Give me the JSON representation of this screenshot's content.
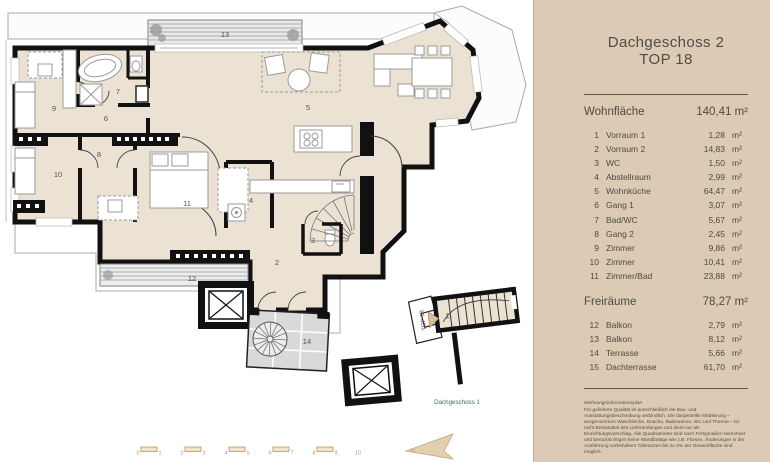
{
  "panel": {
    "title_line1": "Dachgeschoss 2",
    "title_line2": "TOP 18",
    "unit": "m²",
    "wohnflaeche": {
      "label": "Wohnfläche",
      "total": "140,41 m²",
      "items": [
        {
          "nr": "1",
          "name": "Vorraum 1",
          "area": "1,28"
        },
        {
          "nr": "2",
          "name": "Vorraum 2",
          "area": "14,83"
        },
        {
          "nr": "3",
          "name": "WC",
          "area": "1,50"
        },
        {
          "nr": "4",
          "name": "Abstellraum",
          "area": "2,99"
        },
        {
          "nr": "5",
          "name": "Wohnküche",
          "area": "64,47"
        },
        {
          "nr": "6",
          "name": "Gang 1",
          "area": "3,07"
        },
        {
          "nr": "7",
          "name": "Bad/WC",
          "area": "5,67"
        },
        {
          "nr": "8",
          "name": "Gang 2",
          "area": "2,45"
        },
        {
          "nr": "9",
          "name": "Zimmer",
          "area": "9,86"
        },
        {
          "nr": "10",
          "name": "Zimmer",
          "area": "10,41"
        },
        {
          "nr": "11",
          "name": "Zimmer/Bad",
          "area": "23,88"
        }
      ]
    },
    "freiraeume": {
      "label": "Freiräume",
      "total": "78,27 m²",
      "items": [
        {
          "nr": "12",
          "name": "Balkon",
          "area": "2,79"
        },
        {
          "nr": "13",
          "name": "Balkon",
          "area": "8,12"
        },
        {
          "nr": "14",
          "name": "Terrasse",
          "area": "5,66"
        },
        {
          "nr": "15",
          "name": "Dachterrasse",
          "area": "61,70"
        }
      ]
    },
    "footnote_title": "Wohnungsinformationsplan",
    "footnote": "Für gelieferte Qualität ist ausschließlich die Bau- und Ausstattungsbeschreibung verbindlich. Die dargestellte Möblierung – ausgenommen Waschtische, Dusche, Badewanne, WC und Therme – ist nicht Bestandteil des Lieferumfanges und dient nur als Einrichtungsvorschlag. Alle Quadratmeter sind nach Fertigmaßen berechnet und berücksichtigen keine Wandbeläge wie z.B. Fliesen. Änderungen in der Ausführung vorbehalten! Toleranzen bis zu 3% der Gesamtfläche sind möglich."
  },
  "plan": {
    "room_labels": {
      "r1": "1",
      "r2": "2",
      "r3": "3",
      "r4": "4",
      "r5": "5",
      "r6": "6",
      "r7": "7",
      "r8": "8",
      "r9": "9",
      "r10": "10",
      "r11": "11",
      "r12": "12",
      "r13": "13",
      "r14": "14"
    },
    "top18_label": "TOP 18",
    "floor_below_label": "Dachgeschoss 1",
    "north_label": "N",
    "scale_ticks": [
      "0",
      "1",
      "2",
      "3",
      "4",
      "5",
      "6",
      "7",
      "8",
      "9",
      "10"
    ]
  },
  "colors": {
    "panel_bg": "#dccab4",
    "room_fill": "#ece2d4",
    "wall": "#111111",
    "terrace_tile": "#d9d9d9",
    "scale_accent": "#c0945e",
    "floor_below_text": "#3d6868"
  }
}
